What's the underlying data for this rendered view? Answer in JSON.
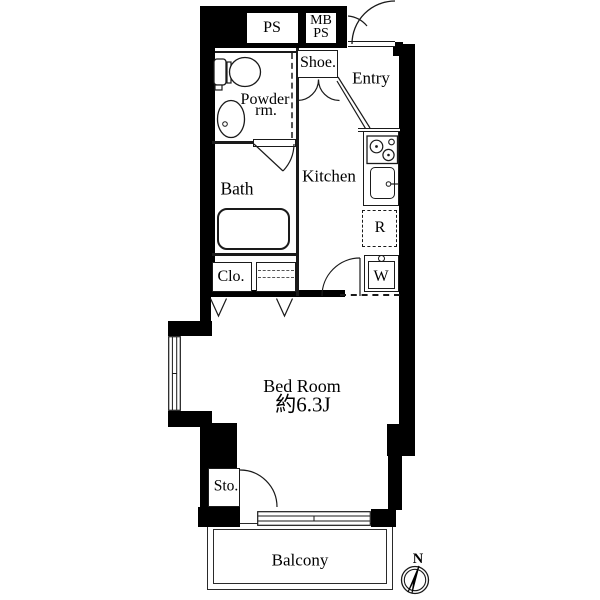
{
  "title": "apartment-floor-plan",
  "colors": {
    "wall": "#000000",
    "line": "#1a1a1a",
    "background": "#ffffff"
  },
  "shafts": {
    "ps_label": "PS",
    "mb_ps_line1": "MB",
    "mb_ps_line2": "PS"
  },
  "rooms": {
    "shoe": {
      "label": "Shoe."
    },
    "entry": {
      "label": "Entry"
    },
    "powder": {
      "label_line1": "Powder",
      "label_line2": "rm."
    },
    "kitchen": {
      "label": "Kitchen"
    },
    "bath": {
      "label": "Bath"
    },
    "closet": {
      "label": "Clo."
    },
    "bedroom": {
      "label": "Bed Room",
      "size": "約6.3J"
    },
    "storage": {
      "label": "Sto."
    },
    "balcony": {
      "label": "Balcony"
    }
  },
  "fixtures": {
    "refrigerator_label": "R",
    "washer_label": "W"
  },
  "compass": {
    "north_label": "N"
  },
  "icons": {
    "toilet-icon": "toilet plan symbol",
    "washbasin-icon": "oval basin symbol",
    "bathtub-icon": "bathtub symbol",
    "stove-icon": "two-burner stove symbol",
    "kitchen-sink-icon": "sink with faucet symbol",
    "door-arc-icon": "door swing arc",
    "window-icon": "double-line window symbol",
    "compass-icon": "north compass needle"
  }
}
